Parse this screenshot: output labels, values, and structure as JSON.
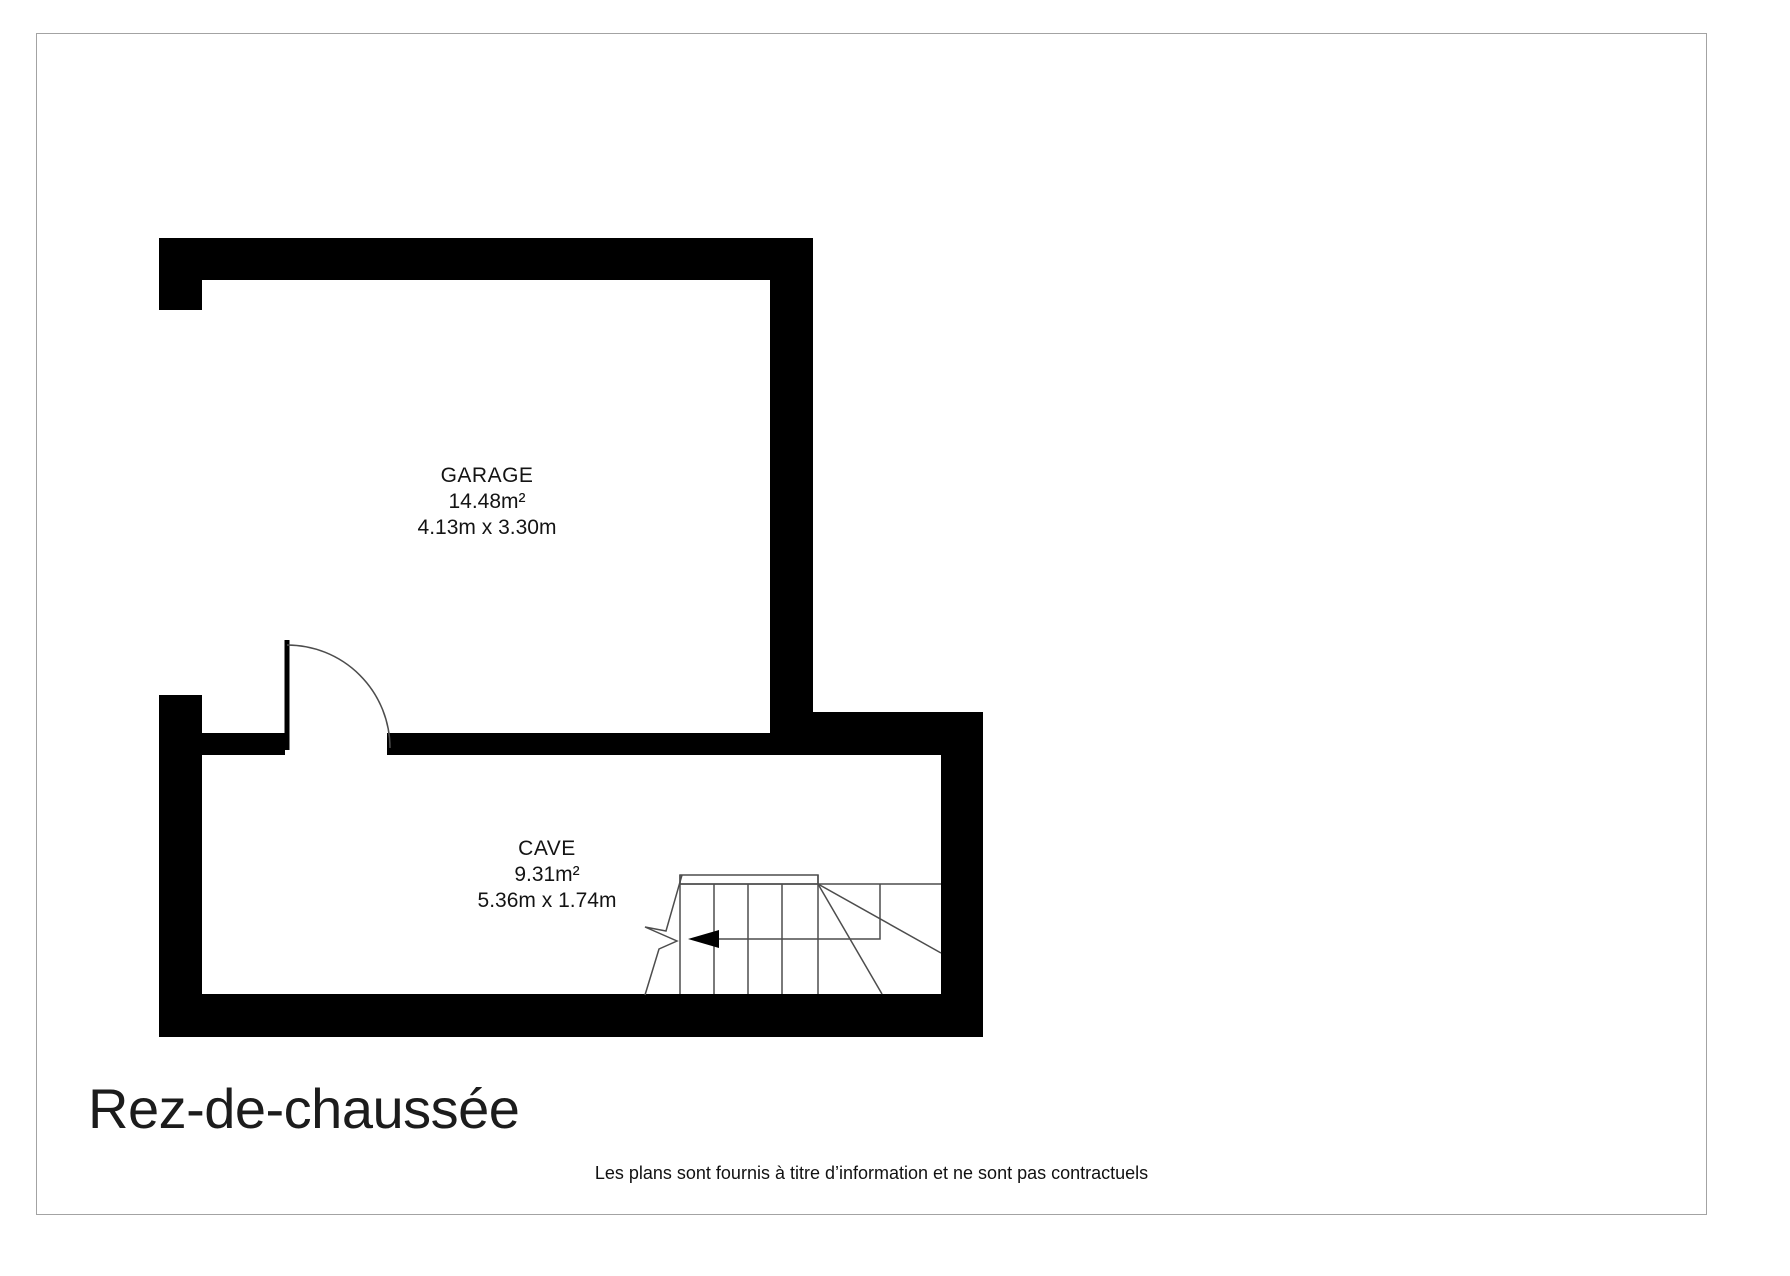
{
  "page": {
    "background": "#ffffff",
    "border_color": "#a3a3a3"
  },
  "plan": {
    "wall_color": "#000000",
    "line_color": "#4d4d4d",
    "rooms": [
      {
        "name": "GARAGE",
        "area": "14.48m²",
        "dimensions": "4.13m x 3.30m"
      },
      {
        "name": "CAVE",
        "area": "9.31m²",
        "dimensions": "5.36m x 1.74m"
      }
    ]
  },
  "footer": {
    "floor_title": "Rez-de-chaussée",
    "disclaimer": "Les plans sont fournis à titre d’information et ne sont pas contractuels"
  }
}
